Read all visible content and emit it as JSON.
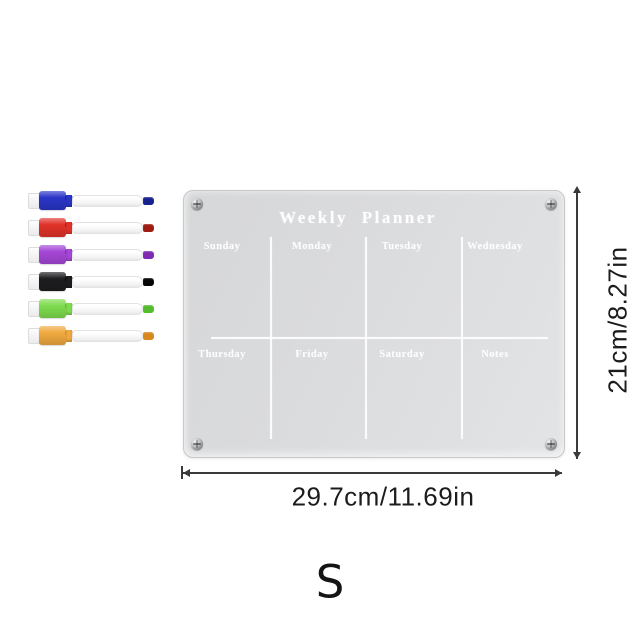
{
  "planner_board": {
    "title": "Weekly Planner",
    "cells_row1": [
      "Sunday",
      "Monday",
      "Tuesday",
      "Wednesday"
    ],
    "cells_row2": [
      "Thursday",
      "Friday",
      "Saturday",
      "Notes"
    ],
    "board_color": "#dadbdd",
    "grid_color": "#ffffff",
    "label_color": "#ffffff"
  },
  "dimension_annotations": {
    "height_label": "21cm/8.27in",
    "width_label": "29.7cm/11.69in",
    "line_color": "#3a3a3a"
  },
  "size_variant_label": "S",
  "markers": [
    {
      "name": "blue dry-erase marker",
      "cap_color": "#2a35c7",
      "accent_color": "#18228f"
    },
    {
      "name": "red dry-erase marker",
      "cap_color": "#e13228",
      "accent_color": "#9e1c12"
    },
    {
      "name": "purple dry-erase marker",
      "cap_color": "#a446d6",
      "accent_color": "#7e2ab2"
    },
    {
      "name": "black dry-erase marker",
      "cap_color": "#1d1d1f",
      "accent_color": "#050505"
    },
    {
      "name": "green dry-erase marker",
      "cap_color": "#7edc4e",
      "accent_color": "#54bd2e"
    },
    {
      "name": "orange dry-erase marker",
      "cap_color": "#f0a93f",
      "accent_color": "#d8881f"
    }
  ]
}
